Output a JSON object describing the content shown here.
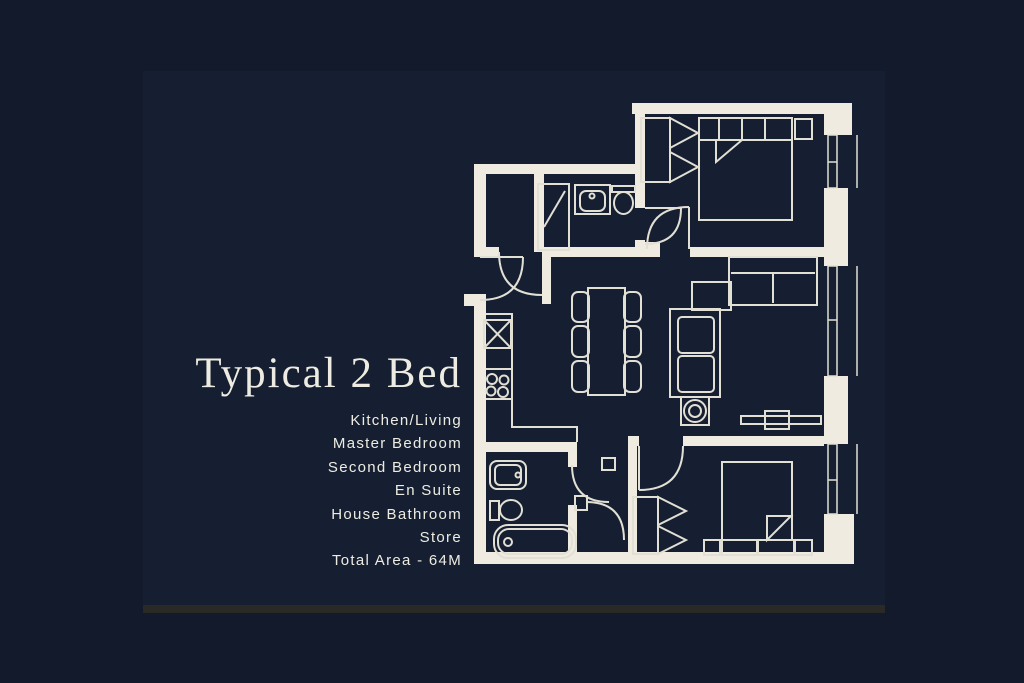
{
  "title": "Typical 2 Bed",
  "details": [
    "Kitchen/Living",
    "Master Bedroom",
    "Second Bedroom",
    "En Suite",
    "House Bathroom",
    "Store",
    "Total Area - 64M"
  ],
  "colors": {
    "outer_background": "#121a2b",
    "panel_background": "#151f31",
    "bottom_strip": "#2b2a26",
    "text": "#eeece2",
    "plan_wall": "#efebe0",
    "plan_line": "#e2dfd4"
  }
}
